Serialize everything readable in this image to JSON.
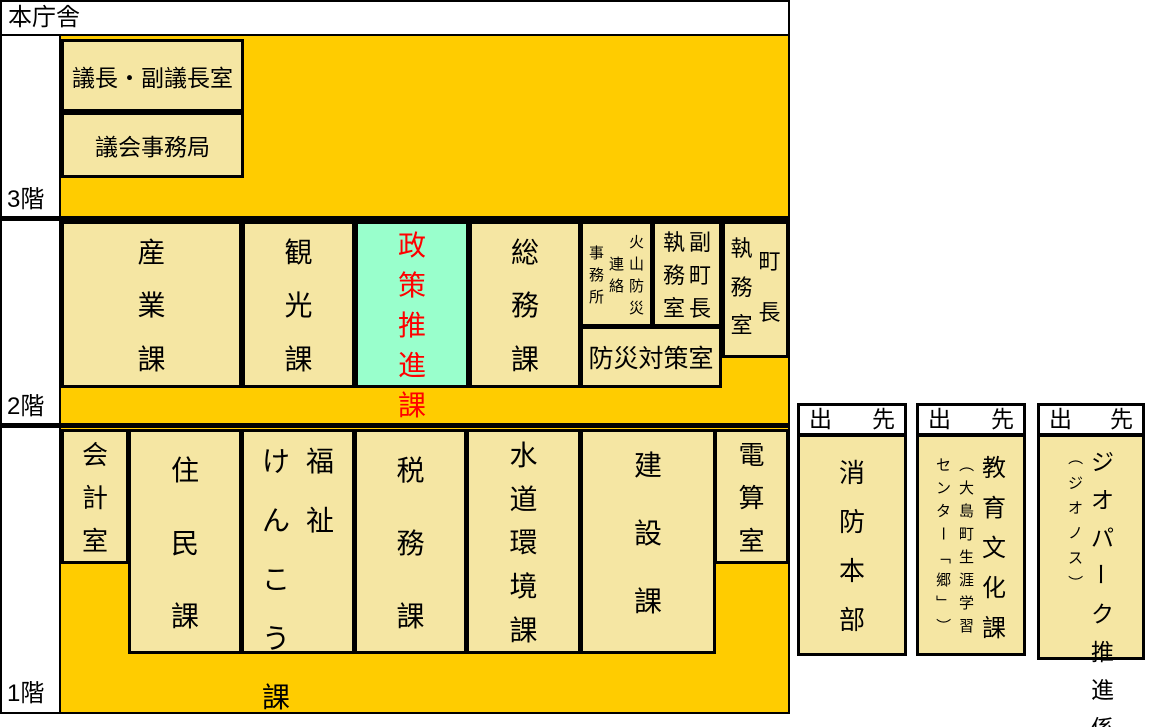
{
  "title": "本庁舎",
  "colors": {
    "background_orange": "#FFCC00",
    "room_tan": "#F5E6A3",
    "highlight_mint": "#99FFCC",
    "highlight_text_red": "#FF0000",
    "line_black": "#000000"
  },
  "floors": {
    "f3": {
      "label": "3階",
      "rooms": {
        "gicho": "議長・副議長室",
        "jimukyoku": "議会事務局"
      }
    },
    "f2": {
      "label": "2階",
      "rooms": {
        "sangyo": "産業課",
        "kanko": "観光課",
        "seisaku": "政策推進課",
        "somu": "総務課",
        "kazan": "火山防災\n連絡\n事務所",
        "fukucho": "副町長\n執務室",
        "cho": "町長\n執務室",
        "bosai": "防災対策室"
      }
    },
    "f1": {
      "label": "1階",
      "rooms": {
        "kaikei": "会計室",
        "jumin": "住民課",
        "fukushi": "福祉\nけんこう課",
        "zeimu": "税務課",
        "suido": "水道環境課",
        "kensetsu": "建設課",
        "densan": "電算室"
      }
    }
  },
  "branches": {
    "header": "出先",
    "fire": "消防本部",
    "edu": "教育文化課\n（大島町生涯学習\nセンター「郷」）",
    "geo": "ジオパーク推進係\n（ジオノス）"
  }
}
